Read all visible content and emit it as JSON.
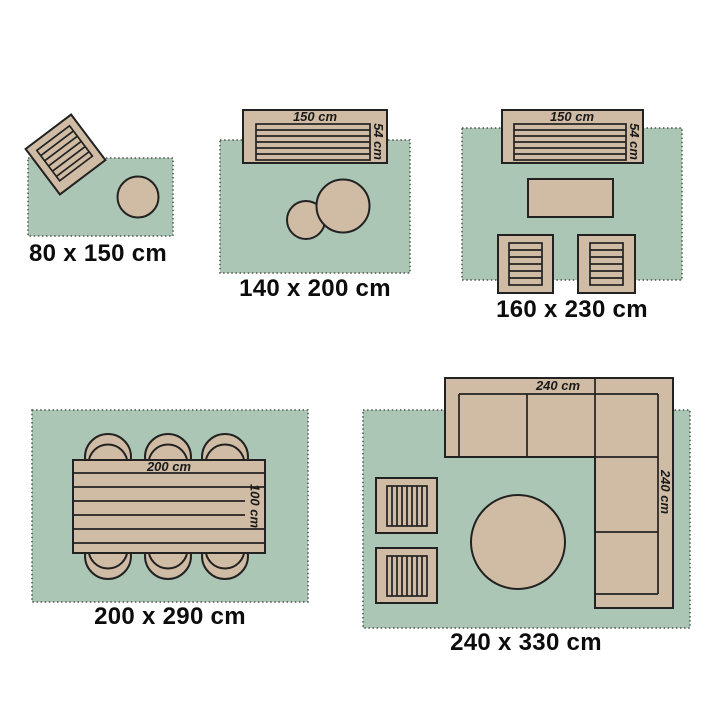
{
  "colors": {
    "background": "#ffffff",
    "rug_fill": "#acc6b6",
    "rug_border": "#4b5349",
    "furniture_fill": "#d0bca4",
    "outline": "#222222",
    "dim_text": "#1a1a1a",
    "label_text": "#0c0c0c"
  },
  "panels": [
    {
      "size_label": "80 x 150 cm"
    },
    {
      "size_label": "140 x 200 cm",
      "sofa_width": "150 cm",
      "sofa_depth": "54 cm"
    },
    {
      "size_label": "160 x 230 cm",
      "sofa_width": "150 cm",
      "sofa_depth": "54 cm"
    },
    {
      "size_label": "200 x 290 cm",
      "table_length": "200 cm",
      "table_width": "100 cm"
    },
    {
      "size_label": "240 x 330 cm",
      "sofa_width": "240 cm",
      "sofa_depth": "240 cm"
    }
  ]
}
